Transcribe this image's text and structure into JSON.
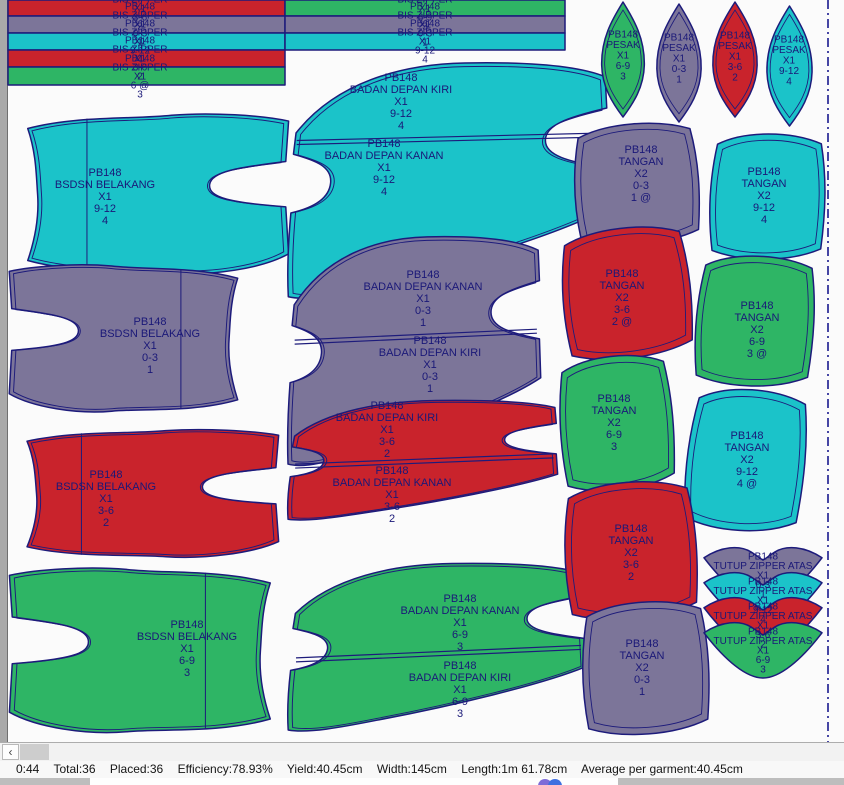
{
  "status": {
    "segments": [
      "0:44",
      "Total:36",
      "Placed:36",
      "Efficiency:78.93%",
      "Yield:40.45cm",
      "Width:145cm",
      "Length:1m 61.78cm",
      "Average per garment:40.45cm"
    ],
    "full": "0:44  Total:36  Placed:36  Efficiency:78.93%  Yield:40.45cm  Width:145cm  Length:1m 61.78cm  Average per garment:40.45cm"
  },
  "icons": {
    "scroll_left": "‹"
  },
  "colors": {
    "cyan": "#1BC3C9",
    "purple": "#7C7599",
    "red": "#C9232C",
    "green": "#2EB565",
    "outline": "#1D1B7B",
    "text": "#1A1878",
    "marker_bg": "#FBFBFB",
    "edge_gray": "#A9A9A9",
    "dash_line": "#1A1A8F"
  },
  "marker": {
    "style_no": "PB148",
    "pieces": [
      {
        "id": "bis-zipper-3-6-a",
        "shape": "strip",
        "color": "red",
        "x": 8,
        "y": 0,
        "w": 277,
        "h": 16,
        "labels": [
          {
            "cx": 140,
            "cy": 8,
            "lines": [
              "PB148",
              "BIS ZIPPER",
              "X1",
              "3-6",
              "2"
            ]
          }
        ]
      },
      {
        "id": "bis-zipper-0-3-a",
        "shape": "strip",
        "color": "purple",
        "x": 8,
        "y": 16,
        "w": 277,
        "h": 17,
        "labels": [
          {
            "cx": 140,
            "cy": 24,
            "lines": [
              "PB148",
              "BIS ZIPPER",
              "X1",
              "0-3",
              "1"
            ]
          }
        ]
      },
      {
        "id": "bis-zipper-9-12-a",
        "shape": "strip",
        "color": "cyan",
        "x": 8,
        "y": 33,
        "w": 277,
        "h": 17,
        "labels": [
          {
            "cx": 140,
            "cy": 41,
            "lines": [
              "PB148",
              "BIS ZIPPER",
              "X1",
              "9-12",
              "4"
            ]
          }
        ]
      },
      {
        "id": "bis-zipper-3-6-b",
        "shape": "strip",
        "color": "red",
        "x": 8,
        "y": 50,
        "w": 277,
        "h": 17,
        "labels": [
          {
            "cx": 140,
            "cy": 58,
            "lines": [
              "PB148",
              "BIS ZIPPER",
              "X1",
              "3-6",
              "2"
            ]
          }
        ]
      },
      {
        "id": "bis-zipper-6-9-a",
        "shape": "strip",
        "color": "green",
        "x": 8,
        "y": 67,
        "w": 277,
        "h": 18,
        "labels": [
          {
            "cx": 140,
            "cy": 76,
            "lines": [
              "PB148",
              "BIS ZIPPER",
              "X1",
              "6 @",
              "3"
            ]
          }
        ]
      },
      {
        "id": "bis-zipper-6-9-b",
        "shape": "strip",
        "color": "green",
        "x": 285,
        "y": 0,
        "w": 280,
        "h": 16,
        "labels": [
          {
            "cx": 425,
            "cy": 8,
            "lines": [
              "PB148",
              "BIS ZIPPER",
              "X1",
              "6-9",
              "3"
            ]
          }
        ]
      },
      {
        "id": "bis-zipper-0-3-b",
        "shape": "strip",
        "color": "purple",
        "x": 285,
        "y": 16,
        "w": 280,
        "h": 17,
        "labels": [
          {
            "cx": 425,
            "cy": 24,
            "lines": [
              "PB148",
              "BIS ZIPPER",
              "X1",
              "0-3",
              "1"
            ]
          }
        ]
      },
      {
        "id": "bis-zipper-9-12-b",
        "shape": "strip",
        "color": "cyan",
        "x": 285,
        "y": 33,
        "w": 280,
        "h": 17,
        "labels": [
          {
            "cx": 425,
            "cy": 41,
            "lines": [
              "PB148",
              "BIS ZIPPER",
              "X1",
              "9-12",
              "4"
            ]
          }
        ]
      },
      {
        "id": "bsdsn-belakang-9-12",
        "shape": "back",
        "color": "cyan",
        "x": 8,
        "y": 112,
        "w": 282,
        "h": 165,
        "fold": 0.28,
        "labels": [
          {
            "cx": 105,
            "cy": 196,
            "lines": [
              "PB148",
              "BSDSN BELAKANG",
              "X1",
              "9-12",
              "4"
            ]
          }
        ]
      },
      {
        "id": "bsdsn-belakang-0-3",
        "shape": "back",
        "color": "purple",
        "x": 8,
        "y": 263,
        "w": 247,
        "h": 152,
        "mirror": true,
        "fold": 0.3,
        "labels": [
          {
            "cx": 150,
            "cy": 345,
            "lines": [
              "PB148",
              "BSDSN BELAKANG",
              "X1",
              "0-3",
              "1"
            ]
          }
        ]
      },
      {
        "id": "bsdsn-belakang-3-6",
        "shape": "back",
        "color": "red",
        "x": 8,
        "y": 428,
        "w": 272,
        "h": 132,
        "fold": 0.27,
        "labels": [
          {
            "cx": 106,
            "cy": 498,
            "lines": [
              "PB148",
              "BSDSN BELAKANG",
              "X1",
              "3-6",
              "2"
            ]
          }
        ]
      },
      {
        "id": "bsdsn-belakang-6-9",
        "shape": "back",
        "color": "green",
        "x": 8,
        "y": 566,
        "w": 282,
        "h": 170,
        "mirror": true,
        "fold": 0.3,
        "labels": [
          {
            "cx": 187,
            "cy": 648,
            "lines": [
              "PB148",
              "BSDSN BELAKANG",
              "X1",
              "6-9",
              "3"
            ]
          }
        ]
      },
      {
        "id": "badan-depan-pair-9-12",
        "shape": "frontpair",
        "color": "cyan",
        "x": 287,
        "y": 58,
        "w": 323,
        "h": 250,
        "diag": [
          0.33,
          0.3
        ],
        "labels": [
          {
            "cx": 401,
            "cy": 101,
            "lines": [
              "PB148",
              "BADAN DEPAN KIRI",
              "X1",
              "9-12",
              "4"
            ]
          },
          {
            "cx": 384,
            "cy": 167,
            "lines": [
              "PB148",
              "BADAN DEPAN KANAN",
              "X1",
              "9-12",
              "4"
            ]
          }
        ]
      },
      {
        "id": "badan-depan-pair-0-3",
        "shape": "frontpair",
        "color": "purple",
        "x": 287,
        "y": 232,
        "w": 255,
        "h": 243,
        "diag": [
          0.445,
          0.4
        ],
        "labels": [
          {
            "cx": 423,
            "cy": 298,
            "lines": [
              "PB148",
              "BADAN DEPAN KANAN",
              "X1",
              "0-3",
              "1"
            ]
          },
          {
            "cx": 430,
            "cy": 364,
            "lines": [
              "PB148",
              "BADAN DEPAN KIRI",
              "X1",
              "0-3",
              "1"
            ]
          }
        ]
      },
      {
        "id": "badan-depan-pair-3-6",
        "shape": "frontpair",
        "color": "red",
        "x": 287,
        "y": 398,
        "w": 272,
        "h": 127,
        "diag": [
          0.52,
          0.44
        ],
        "labels": [
          {
            "cx": 387,
            "cy": 429,
            "lines": [
              "PB148",
              "BADAN DEPAN KIRI",
              "X1",
              "3-6",
              "2"
            ]
          },
          {
            "cx": 392,
            "cy": 494,
            "lines": [
              "PB148",
              "BADAN DEPAN KANAN",
              "X1",
              "3-6",
              "2"
            ]
          }
        ]
      },
      {
        "id": "badan-depan-pair-6-9",
        "shape": "frontpair",
        "color": "green",
        "x": 287,
        "y": 560,
        "w": 300,
        "h": 178,
        "diag": [
          0.55,
          0.48
        ],
        "labels": [
          {
            "cx": 460,
            "cy": 622,
            "lines": [
              "PB148",
              "BADAN DEPAN KANAN",
              "X1",
              "6-9",
              "3"
            ]
          },
          {
            "cx": 460,
            "cy": 689,
            "lines": [
              "PB148",
              "BADAN DEPAN KIRI",
              "X1",
              "6-9",
              "3"
            ]
          }
        ]
      },
      {
        "id": "tangan-0-3-stack",
        "shape": "tangan",
        "color": "purple",
        "x": 570,
        "y": 120,
        "w": 132,
        "h": 128,
        "rot": -3,
        "labels": [
          {
            "cx": 641,
            "cy": 173,
            "lines": [
              "PB148",
              "TANGAN",
              "X2",
              "0-3",
              "1 @"
            ]
          }
        ]
      },
      {
        "id": "tangan-9-12-a",
        "shape": "tangan",
        "color": "cyan",
        "x": 706,
        "y": 130,
        "w": 122,
        "h": 133,
        "rot": 2,
        "labels": [
          {
            "cx": 764,
            "cy": 195,
            "lines": [
              "PB148",
              "TANGAN",
              "X2",
              "9-12",
              "4"
            ]
          }
        ]
      },
      {
        "id": "tangan-3-6-stack",
        "shape": "tangan",
        "color": "red",
        "x": 558,
        "y": 224,
        "w": 136,
        "h": 138,
        "rot": -5,
        "labels": [
          {
            "cx": 622,
            "cy": 297,
            "lines": [
              "PB148",
              "TANGAN",
              "X2",
              "3-6",
              "2 @"
            ]
          }
        ]
      },
      {
        "id": "tangan-6-9-stack",
        "shape": "tangan",
        "color": "green",
        "x": 692,
        "y": 252,
        "w": 125,
        "h": 138,
        "rot": 4,
        "labels": [
          {
            "cx": 757,
            "cy": 329,
            "lines": [
              "PB148",
              "TANGAN",
              "X2",
              "6-9",
              "3 @"
            ]
          }
        ]
      },
      {
        "id": "tangan-6-9-b",
        "shape": "tangan",
        "color": "green",
        "x": 556,
        "y": 352,
        "w": 120,
        "h": 142,
        "rot": -4,
        "labels": [
          {
            "cx": 614,
            "cy": 422,
            "lines": [
              "PB148",
              "TANGAN",
              "X2",
              "6-9",
              "3"
            ]
          }
        ]
      },
      {
        "id": "tangan-9-12-stack",
        "shape": "tangan",
        "color": "cyan",
        "x": 683,
        "y": 385,
        "w": 125,
        "h": 150,
        "rot": 6,
        "labels": [
          {
            "cx": 747,
            "cy": 459,
            "lines": [
              "PB148",
              "TANGAN",
              "X2",
              "9-12",
              "4 @"
            ]
          }
        ]
      },
      {
        "id": "tangan-3-6-b",
        "shape": "tangan",
        "color": "red",
        "x": 560,
        "y": 478,
        "w": 140,
        "h": 145,
        "rot": -3,
        "labels": [
          {
            "cx": 631,
            "cy": 552,
            "lines": [
              "PB148",
              "TANGAN",
              "X2",
              "3-6",
              "2"
            ]
          }
        ]
      },
      {
        "id": "tangan-0-3-b",
        "shape": "tangan",
        "color": "purple",
        "x": 578,
        "y": 598,
        "w": 134,
        "h": 140,
        "rot": -2,
        "labels": [
          {
            "cx": 642,
            "cy": 667,
            "lines": [
              "PB148",
              "TANGAN",
              "X2",
              "0-3",
              "1"
            ]
          }
        ]
      },
      {
        "id": "pesak-6-9",
        "shape": "pesak",
        "color": "green",
        "x": 597,
        "y": 2,
        "w": 52,
        "h": 115,
        "labels": [
          {
            "cx": 623,
            "cy": 55,
            "lines": [
              "PB148",
              "PESAK",
              "X1",
              "6-9",
              "3"
            ]
          }
        ]
      },
      {
        "id": "pesak-0-3",
        "shape": "pesak",
        "color": "purple",
        "x": 652,
        "y": 4,
        "w": 54,
        "h": 118,
        "labels": [
          {
            "cx": 679,
            "cy": 58,
            "lines": [
              "PB148",
              "PESAK",
              "X1",
              "0-3",
              "1"
            ]
          }
        ]
      },
      {
        "id": "pesak-3-6",
        "shape": "pesak",
        "color": "red",
        "x": 708,
        "y": 2,
        "w": 54,
        "h": 115,
        "labels": [
          {
            "cx": 735,
            "cy": 56,
            "lines": [
              "PB148",
              "PESAK",
              "X1",
              "3-6",
              "2"
            ]
          }
        ]
      },
      {
        "id": "pesak-9-12",
        "shape": "pesak",
        "color": "cyan",
        "x": 762,
        "y": 6,
        "w": 55,
        "h": 120,
        "labels": [
          {
            "cx": 789,
            "cy": 60,
            "lines": [
              "PB148",
              "PESAK",
              "X1",
              "9-12",
              "4"
            ]
          }
        ]
      },
      {
        "id": "tutup-zipper-atas-0-3",
        "shape": "tutup",
        "color": "purple",
        "x": 704,
        "y": 545,
        "w": 118,
        "h": 58,
        "labels": [
          {
            "cx": 763,
            "cy": 575,
            "lines": [
              "PB148",
              "TUTUP ZIPPER ATAS",
              "X1",
              "0-3",
              "1"
            ]
          }
        ]
      },
      {
        "id": "tutup-zipper-atas-9-12",
        "shape": "tutup",
        "color": "cyan",
        "x": 704,
        "y": 570,
        "w": 118,
        "h": 58,
        "labels": [
          {
            "cx": 763,
            "cy": 600,
            "lines": [
              "PB148",
              "TUTUP ZIPPER ATAS",
              "X1",
              "9-12",
              "4"
            ]
          }
        ]
      },
      {
        "id": "tutup-zipper-atas-3-6",
        "shape": "tutup",
        "color": "red",
        "x": 704,
        "y": 595,
        "w": 118,
        "h": 58,
        "labels": [
          {
            "cx": 763,
            "cy": 625,
            "lines": [
              "PB148",
              "TUTUP ZIPPER ATAS",
              "X1",
              "3-6",
              "2"
            ]
          }
        ]
      },
      {
        "id": "tutup-zipper-atas-6-9",
        "shape": "tutup",
        "color": "green",
        "x": 704,
        "y": 620,
        "w": 118,
        "h": 58,
        "labels": [
          {
            "cx": 763,
            "cy": 650,
            "lines": [
              "PB148",
              "TUTUP ZIPPER ATAS",
              "X1",
              "6-9",
              "3"
            ]
          }
        ]
      }
    ]
  }
}
